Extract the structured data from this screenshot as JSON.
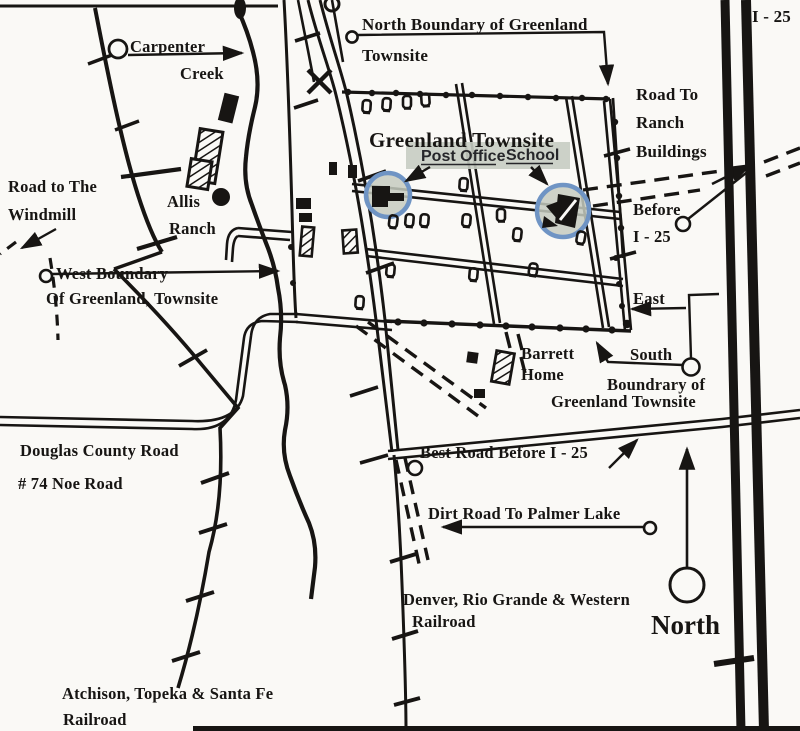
{
  "map": {
    "title": "Greenland Townsite historic hand-drawn map",
    "colors": {
      "paper": "#faf9f6",
      "ink": "#171513",
      "site_circle_ring": "#6f94c4",
      "site_circle_fill": "#c5cbc0",
      "label_highlight": "#c7ccc3"
    },
    "labels": {
      "carpenter_line1": "Carpenter",
      "carpenter_line2": "Creek",
      "north_boundary_line1": "North Boundary of Greenland",
      "north_boundary_line2": "Townsite",
      "i25_top": "I - 25",
      "road_ranch_line1": "Road To",
      "road_ranch_line2": "Ranch",
      "road_ranch_line3": "Buildings",
      "townsite_title": "Greenland Townsite",
      "post_office": "Post Office",
      "school": "School",
      "windmill_line1": "Road to The",
      "windmill_line2": "Windmill",
      "allis_line1": "Allis",
      "allis_line2": "Ranch",
      "before_line1": "Before",
      "before_line2": "I - 25",
      "west_boundary_line1": "West Boundary",
      "west_boundary_line2": "Of Greenland, Townsite",
      "east": "East",
      "south": "South",
      "south_boundary_line1": "Boundrary of",
      "south_boundary_line2": "Greenland Townsite",
      "barrett_line1": "Barrett",
      "barrett_line2": "Home",
      "douglas_line1": "Douglas County Road",
      "douglas_line2": "# 74 Noe Road",
      "best_road": "Best Road Before I - 25",
      "dirt_road": "Dirt Road To Palmer Lake",
      "drgw_line1": "Denver, Rio Grande & Western",
      "drgw_line2": "Railroad",
      "compass_north": "North",
      "atsf_line1": "Atchison, Topeka & Santa Fe",
      "atsf_line2": "Railroad"
    }
  }
}
